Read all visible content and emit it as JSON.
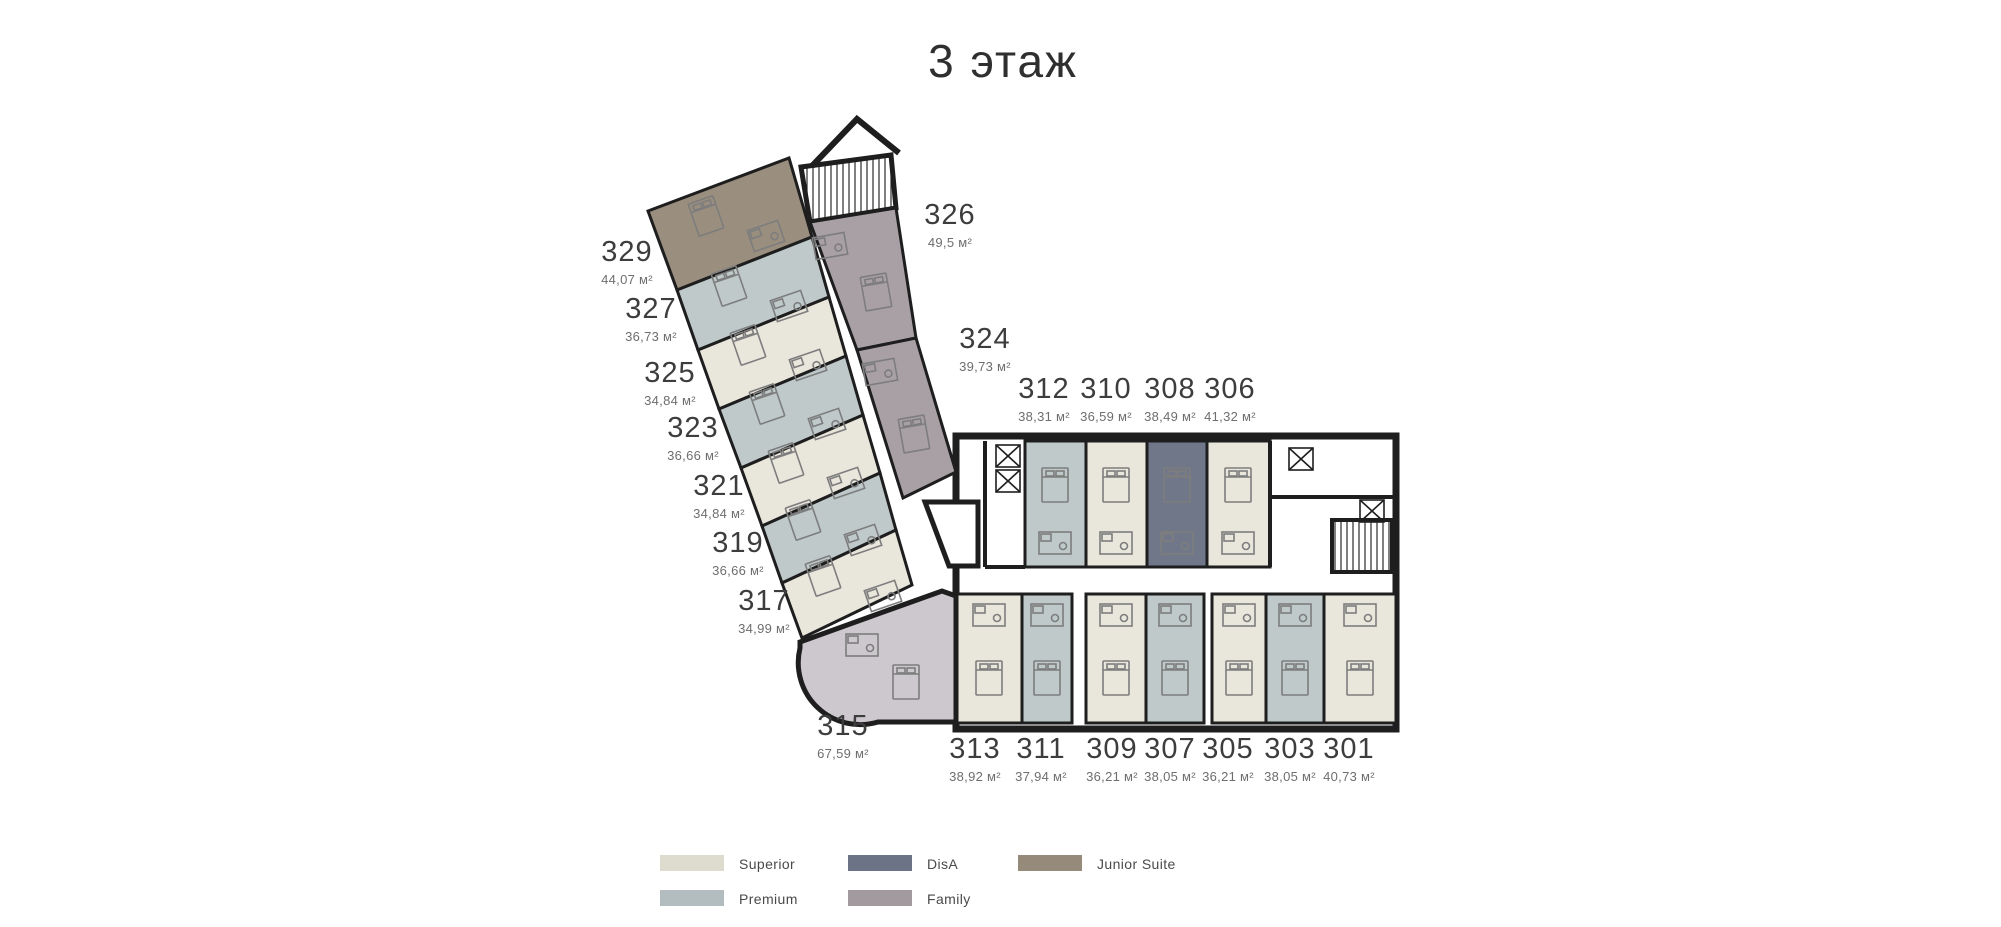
{
  "title": "3 этаж",
  "legend": {
    "items": [
      {
        "id": "superior",
        "label": "Superior",
        "color": "#dedbcf"
      },
      {
        "id": "premium",
        "label": "Premium",
        "color": "#b3bcbe"
      },
      {
        "id": "disa",
        "label": "DisA",
        "color": "#6c7386"
      },
      {
        "id": "family",
        "label": "Family",
        "color": "#a39aa0"
      },
      {
        "id": "junior_suite",
        "label": "Junior Suite",
        "color": "#968a7a"
      }
    ]
  },
  "plan_fills": {
    "superior": "#e9e6dc",
    "premium": "#bfc9ca",
    "disa": "#6f7789",
    "family": "#a9a0a6",
    "family_light": "#cdc7ce",
    "junior_suite": "#9a8e7e",
    "wall": "#1e1e1e",
    "furniture": "#7d7d7d"
  },
  "rooms": [
    {
      "number": "329",
      "area": "44,07 м²",
      "type": "Junior Suite"
    },
    {
      "number": "327",
      "area": "36,73 м²",
      "type": "Premium"
    },
    {
      "number": "325",
      "area": "34,84 м²",
      "type": "Superior"
    },
    {
      "number": "323",
      "area": "36,66 м²",
      "type": "Premium"
    },
    {
      "number": "321",
      "area": "34,84 м²",
      "type": "Superior"
    },
    {
      "number": "319",
      "area": "36,66 м²",
      "type": "Premium"
    },
    {
      "number": "317",
      "area": "34,99 м²",
      "type": "Superior"
    },
    {
      "number": "315",
      "area": "67,59 м²",
      "type": "Family"
    },
    {
      "number": "326",
      "area": "49,5 м²",
      "type": "Family"
    },
    {
      "number": "324",
      "area": "39,73 м²",
      "type": "Family"
    },
    {
      "number": "312",
      "area": "38,31 м²",
      "type": "Premium"
    },
    {
      "number": "310",
      "area": "36,59 м²",
      "type": "Superior"
    },
    {
      "number": "308",
      "area": "38,49 м²",
      "type": "DisA"
    },
    {
      "number": "306",
      "area": "41,32 м²",
      "type": "Superior"
    },
    {
      "number": "313",
      "area": "38,92 м²",
      "type": "Superior"
    },
    {
      "number": "311",
      "area": "37,94 м²",
      "type": "Premium"
    },
    {
      "number": "309",
      "area": "36,21 м²",
      "type": "Superior"
    },
    {
      "number": "307",
      "area": "38,05 м²",
      "type": "Premium"
    },
    {
      "number": "305",
      "area": "36,21 м²",
      "type": "Superior"
    },
    {
      "number": "303",
      "area": "38,05 м²",
      "type": "Premium"
    },
    {
      "number": "301",
      "area": "40,73 м²",
      "type": "Superior"
    }
  ]
}
